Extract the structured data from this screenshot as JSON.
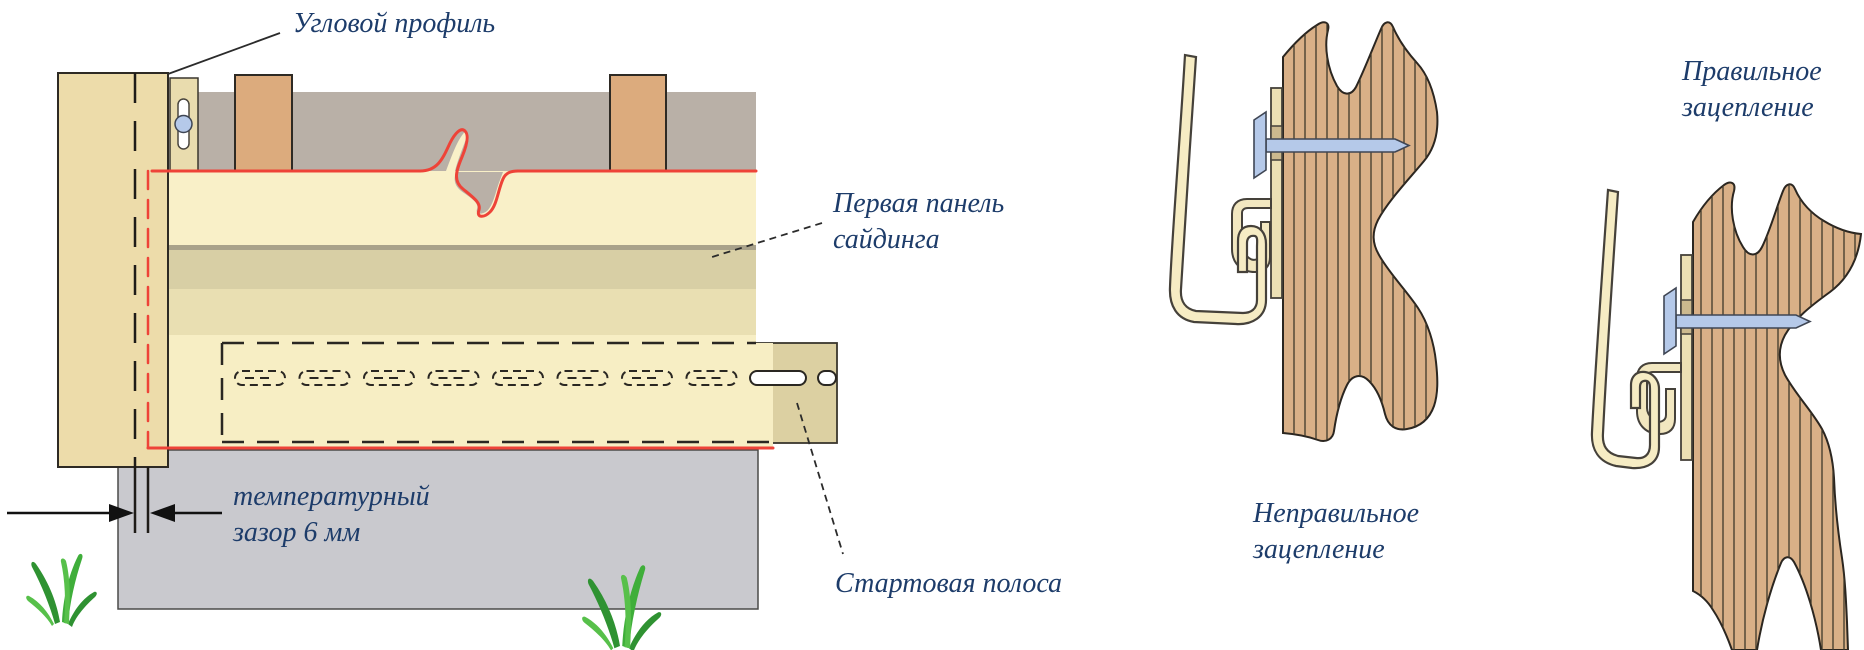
{
  "figure": {
    "labels": {
      "corner_profile": "Угловой профиль",
      "first_panel_line1": "Первая панель",
      "first_panel_line2": "сайдинга",
      "temp_gap_line1": "температурный",
      "temp_gap_line2": "зазор 6 мм",
      "starter_strip": "Стартовая полоса",
      "incorrect_line1": "Неправильное",
      "incorrect_line2": "зацепление",
      "correct_line1": "Правильное",
      "correct_line2": "зацепление"
    },
    "colors": {
      "label_text": "#1d3c6a",
      "wall_grey": "#b9b0a7",
      "stud_brown": "#dcab7d",
      "panel_cream": "#f9f0c8",
      "panel_band_dark": "#d8cfa5",
      "panel_band_light": "#e9dfb2",
      "panel_band_line": "#a9a28a",
      "corner_profile_beige": "#eddcaa",
      "starter_strip_tan": "#dcd0a2",
      "foundation_grey": "#c9c9ce",
      "wood_brown": "#d9b087",
      "hook_cream": "#f4e9c3",
      "nail_blue": "#b5c9e9",
      "red_line": "#ee4338",
      "grass_green": "#3fae3a"
    }
  }
}
